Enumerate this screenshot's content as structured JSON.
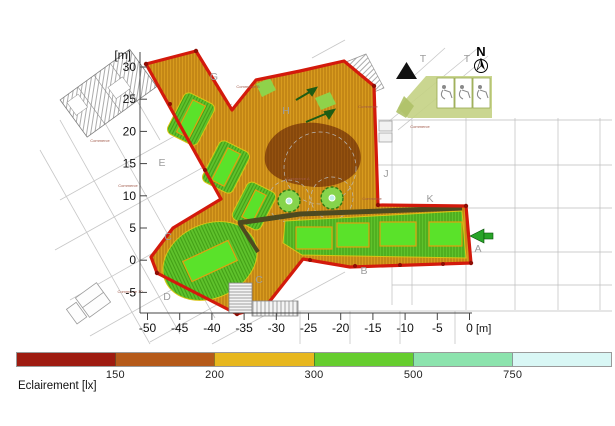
{
  "plan": {
    "north_label": "N",
    "grid_labels": [
      {
        "t": "G",
        "x": 214,
        "y": 80
      },
      {
        "t": "H",
        "x": 286,
        "y": 114
      },
      {
        "t": "E",
        "x": 162,
        "y": 166
      },
      {
        "t": "C",
        "x": 168,
        "y": 240
      },
      {
        "t": "C",
        "x": 259,
        "y": 283
      },
      {
        "t": "D",
        "x": 167,
        "y": 300
      },
      {
        "t": "B",
        "x": 364,
        "y": 274
      },
      {
        "t": "A",
        "x": 478,
        "y": 252
      },
      {
        "t": "K",
        "x": 430,
        "y": 202
      },
      {
        "t": "J",
        "x": 386,
        "y": 177
      },
      {
        "t": "T",
        "x": 423,
        "y": 62
      },
      {
        "t": "T",
        "x": 467,
        "y": 62
      }
    ],
    "annotations": [
      {
        "t": "Commerce",
        "x": 100,
        "y": 142
      },
      {
        "t": "Commerce",
        "x": 128,
        "y": 187
      },
      {
        "t": "Commerce B",
        "x": 248,
        "y": 88
      },
      {
        "t": "Commerce",
        "x": 368,
        "y": 108
      },
      {
        "t": "Commerce A",
        "x": 298,
        "y": 180
      },
      {
        "t": "Commerce",
        "x": 420,
        "y": 128
      },
      {
        "t": "Commerce 10",
        "x": 130,
        "y": 293
      },
      {
        "t": "Commerce",
        "x": 372,
        "y": 200
      }
    ]
  },
  "axes": {
    "unit": "[m]",
    "y_ticks": [
      "30",
      "25",
      "20",
      "15",
      "10",
      "5",
      "0",
      "-5"
    ],
    "x_ticks": [
      "-50",
      "-45",
      "-40",
      "-35",
      "-30",
      "-25",
      "-20",
      "-15",
      "-10",
      "-5",
      "0"
    ]
  },
  "legend": {
    "title": "Eclairement [lx]",
    "bands": [
      {
        "color": "#9E1B10",
        "boundary_label": "150"
      },
      {
        "color": "#B55A1A",
        "boundary_label": "200"
      },
      {
        "color": "#E7B71E",
        "boundary_label": "300"
      },
      {
        "color": "#66CD2E",
        "boundary_label": "500"
      },
      {
        "color": "#8CE3AD",
        "boundary_label": "750"
      },
      {
        "color": "#D9F7F5",
        "boundary_label": ""
      }
    ]
  },
  "chart_data": {
    "type": "heatmap",
    "title": "Illuminance false-colour plan (Eclairement)",
    "value_unit": "lx",
    "value_boundaries": [
      150,
      200,
      300,
      500,
      750
    ],
    "band_colors": [
      "#9E1B10",
      "#B55A1A",
      "#E7B71E",
      "#66CD2E",
      "#8CE3AD",
      "#D9F7F5"
    ],
    "x_axis": {
      "unit": "[m]",
      "ticks": [
        -50,
        -45,
        -40,
        -35,
        -30,
        -25,
        -20,
        -15,
        -10,
        -5,
        0
      ]
    },
    "y_axis": {
      "unit": "[m]",
      "ticks": [
        30,
        25,
        20,
        15,
        10,
        5,
        0,
        -5
      ]
    },
    "legend_label": "Eclairement [lx]"
  }
}
